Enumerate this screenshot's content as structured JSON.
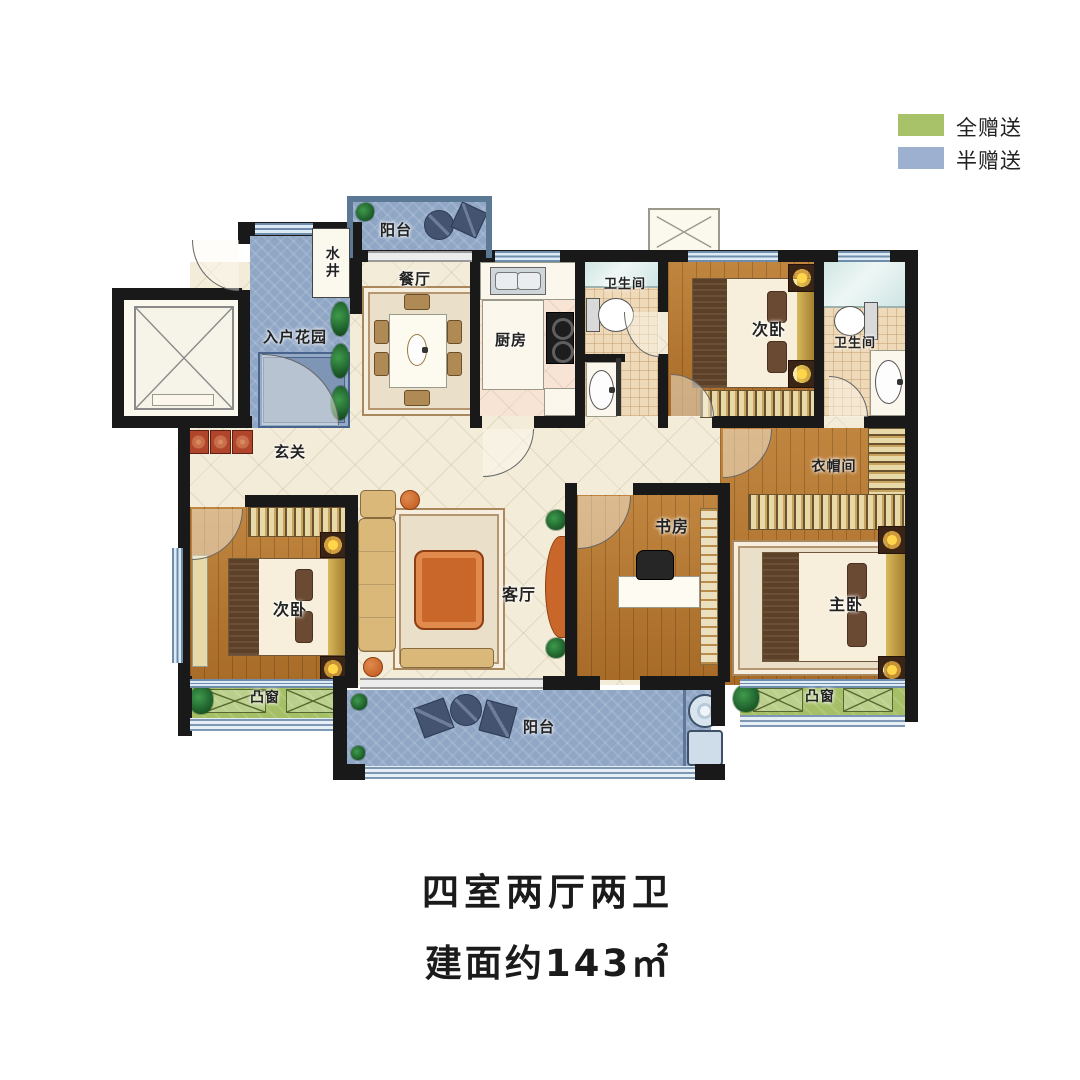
{
  "legend": {
    "items": [
      {
        "name": "full-gift",
        "label": "全赠送",
        "color": "#a8c26a"
      },
      {
        "name": "half-gift",
        "label": "半赠送",
        "color": "#9db0cf"
      }
    ]
  },
  "rooms": {
    "balcony_top": "阳台",
    "water_well": "水井",
    "entry_garden": "入户花园",
    "dining": "餐厅",
    "kitchen": "厨房",
    "bath1": "卫生间",
    "bedroom_top": "次卧",
    "bath2": "卫生间",
    "foyer": "玄关",
    "cloakroom": "衣帽间",
    "bedroom_left": "次卧",
    "living": "客厅",
    "study": "书房",
    "master": "主卧",
    "bay_left": "凸窗",
    "bay_right": "凸窗",
    "balcony_bottom": "阳台"
  },
  "title": {
    "line1": "四室两厅两卫",
    "line2": "建面约143㎡"
  },
  "colors": {
    "wall": "#191919",
    "full_gift_green": "#a5bf66",
    "half_gift_blue": "#8fa6c5",
    "wood_floor": "#b5762e",
    "common_floor": "#f3ecd9",
    "bath_tile": "#eed9b9"
  }
}
